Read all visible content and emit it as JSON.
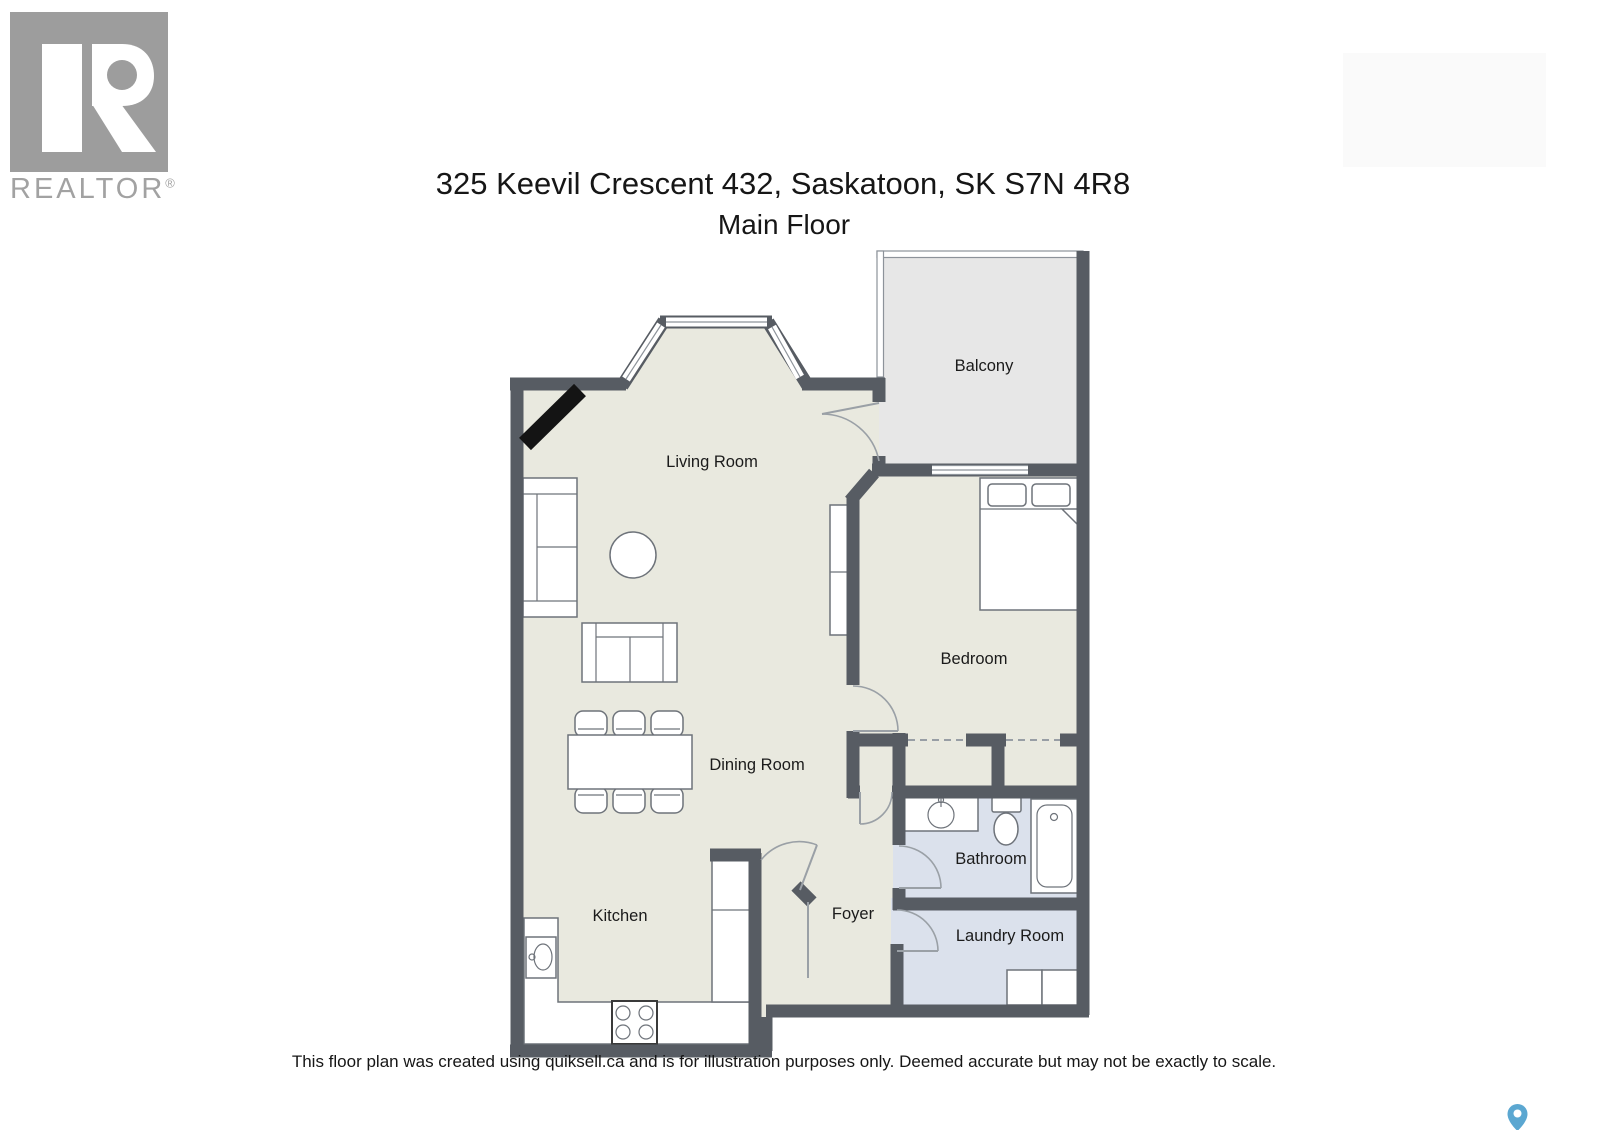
{
  "branding": {
    "logo_text": "REALTOR",
    "registered_mark": "®",
    "logo_color": "#9d9d9d"
  },
  "header": {
    "title": "325 Keevil Crescent 432, Saskatoon, SK S7N 4R8",
    "subtitle": "Main Floor"
  },
  "plan": {
    "colors": {
      "wall": "#575c63",
      "floor": "#e9e9df",
      "balcony_floor": "#e7e7e7",
      "wet_floor": "#dbe1ec",
      "fixture_stroke": "#6e737a",
      "door_arc": "#9aa0a6",
      "label": "#1b1b1b"
    },
    "rooms": [
      {
        "id": "living_room",
        "label": "Living Room"
      },
      {
        "id": "balcony",
        "label": "Balcony"
      },
      {
        "id": "bedroom",
        "label": "Bedroom"
      },
      {
        "id": "dining_room",
        "label": "Dining Room"
      },
      {
        "id": "kitchen",
        "label": "Kitchen"
      },
      {
        "id": "foyer",
        "label": "Foyer"
      },
      {
        "id": "bathroom",
        "label": "Bathroom"
      },
      {
        "id": "laundry_room",
        "label": "Laundry Room"
      }
    ],
    "furniture_icons": [
      "fireplace",
      "sofa",
      "round-side-table",
      "loveseat",
      "dining-table",
      "dining-chairs",
      "storage-cabinet",
      "bed",
      "pillows",
      "kitchen-sink",
      "stove",
      "kitchen-counter",
      "bathroom-vanity-sink",
      "toilet",
      "bathtub",
      "washer",
      "dryer",
      "closet-sliding-doors"
    ]
  },
  "footer": {
    "disclaimer": "This floor plan was created using quiksell.ca and is for illustration purposes only. Deemed accurate but may not be exactly to scale."
  },
  "map_pin": {
    "color": "#5ba7d1"
  }
}
